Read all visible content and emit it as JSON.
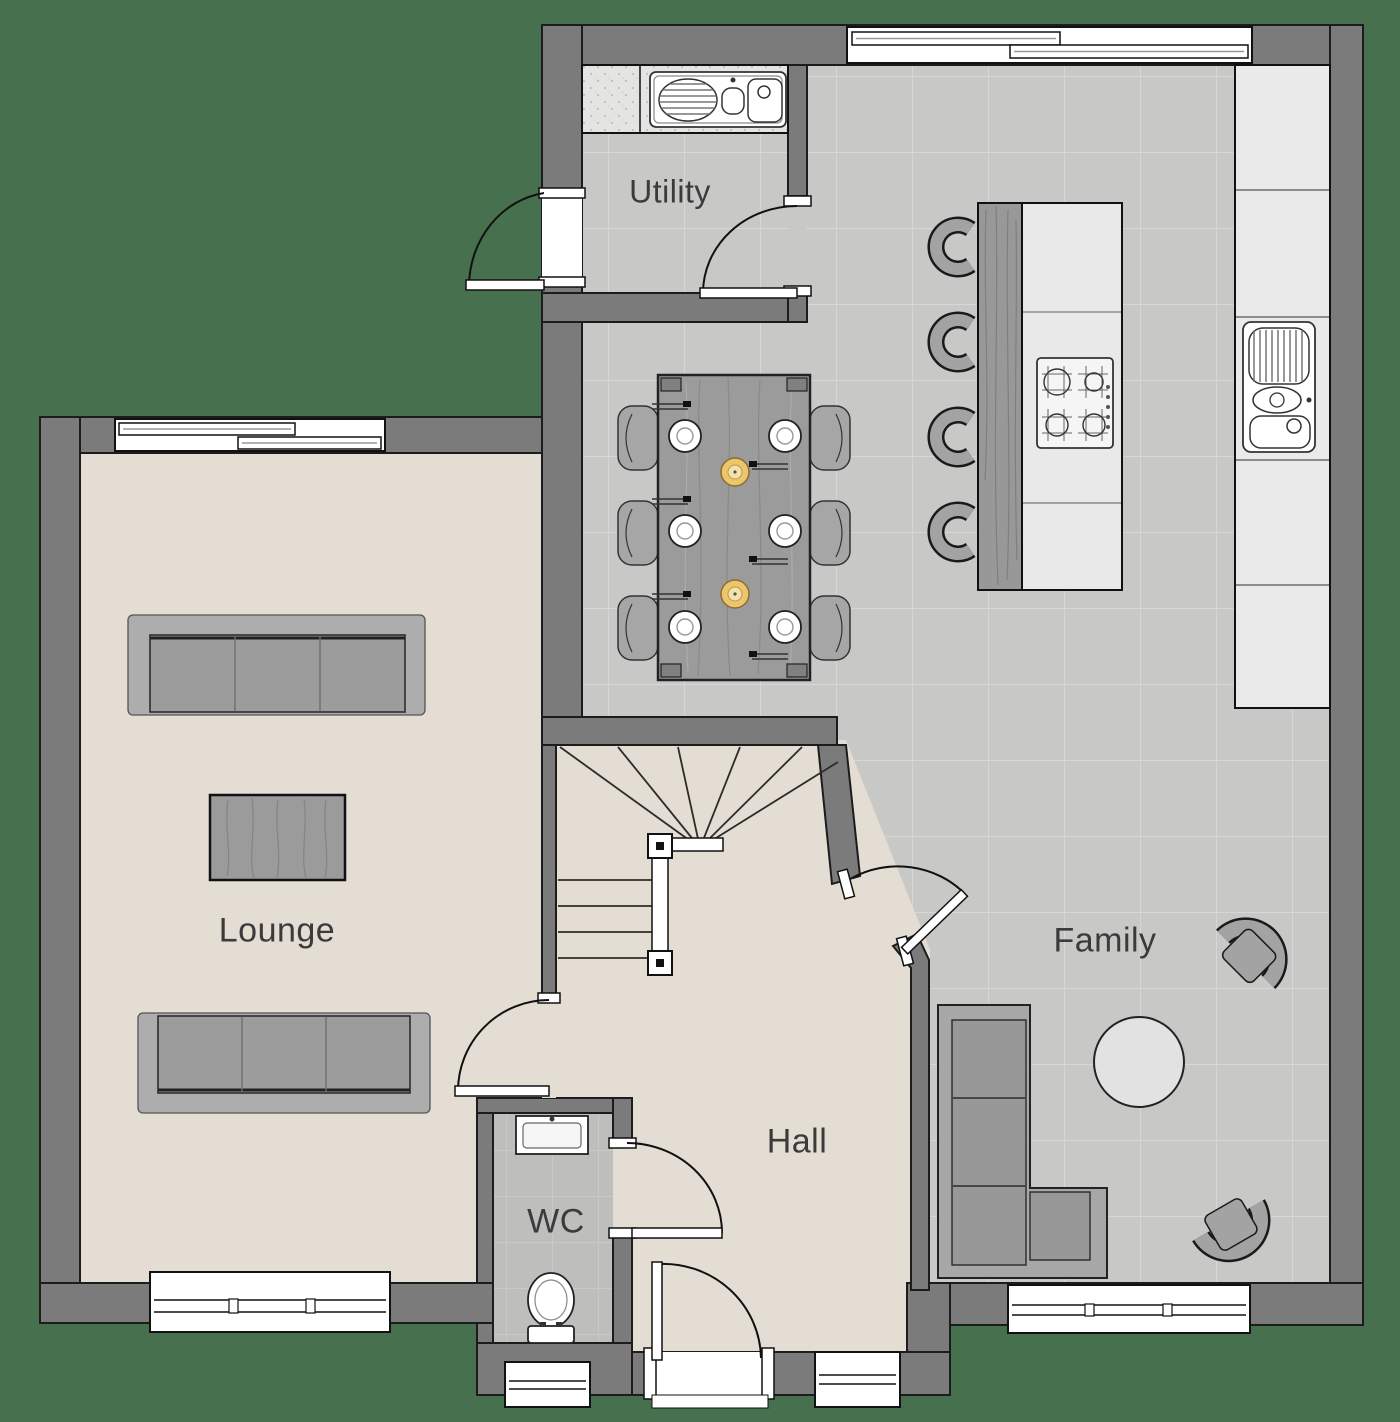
{
  "plan": {
    "rooms": {
      "utility": {
        "label": "Utility"
      },
      "lounge": {
        "label": "Lounge"
      },
      "hall": {
        "label": "Hall"
      },
      "wc": {
        "label": "WC"
      },
      "family": {
        "label": "Family"
      }
    },
    "palette": {
      "exterior_green": "#46704E",
      "wall_gray": "#7B7B7B",
      "tile_floor": "#C8C8C6",
      "carpet_beige": "#E3DDD3",
      "wc_floor": "#BEBEBC",
      "counter_light": "#EAEAEA",
      "furniture_gray": "#A3A3A3",
      "wood_gray": "#9B9B9B",
      "candle_yellow": "#ECC56D"
    }
  }
}
